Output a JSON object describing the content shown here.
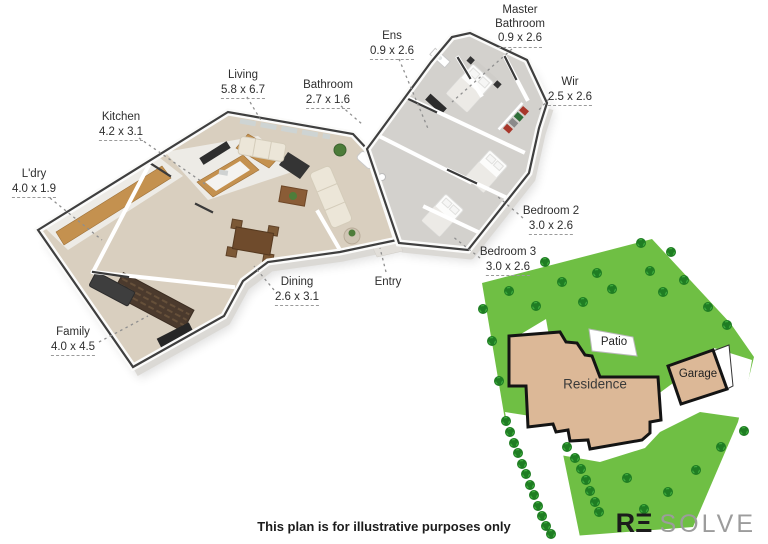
{
  "page": {
    "disclaimer": "This plan is for illustrative purposes only"
  },
  "logo": {
    "re": "RΞ",
    "solve": "SOLVE"
  },
  "floor_plan": {
    "rooms": [
      {
        "id": "master-bathroom",
        "name": "Master Bathroom",
        "dimensions": "0.9 x 2.6"
      },
      {
        "id": "ens",
        "name": "Ens",
        "dimensions": "0.9 x 2.6"
      },
      {
        "id": "wir",
        "name": "Wir",
        "dimensions": "2.5 x 2.6"
      },
      {
        "id": "living",
        "name": "Living",
        "dimensions": "5.8 x 6.7"
      },
      {
        "id": "bathroom",
        "name": "Bathroom",
        "dimensions": "2.7 x 1.6"
      },
      {
        "id": "kitchen",
        "name": "Kitchen",
        "dimensions": "4.2 x 3.1"
      },
      {
        "id": "ldry",
        "name": "L'dry",
        "dimensions": "4.0 x 1.9"
      },
      {
        "id": "bedroom-2",
        "name": "Bedroom 2",
        "dimensions": "3.0 x 2.6"
      },
      {
        "id": "bedroom-3",
        "name": "Bedroom 3",
        "dimensions": "3.0 x 2.6"
      },
      {
        "id": "dining",
        "name": "Dining",
        "dimensions": "2.6 x 3.1"
      },
      {
        "id": "entry",
        "name": "Entry",
        "dimensions": ""
      },
      {
        "id": "family",
        "name": "Family",
        "dimensions": "4.0 x 4.5"
      }
    ]
  },
  "site_plan": {
    "labels": {
      "residence": "Residence",
      "patio": "Patio",
      "garage": "Garage"
    }
  },
  "colors": {
    "grass": "#6fbf44",
    "tree": "#1f7d23",
    "building_fill": "#dcb897",
    "building_outline": "#141414",
    "floor_beige": "#d9cfbf",
    "floor_tile": "#edebe6",
    "carpet_gray": "#d3d1cd",
    "timber": "#c4914f",
    "wall_top": "#3f3f3f",
    "label_text": "#2e2e2e"
  }
}
